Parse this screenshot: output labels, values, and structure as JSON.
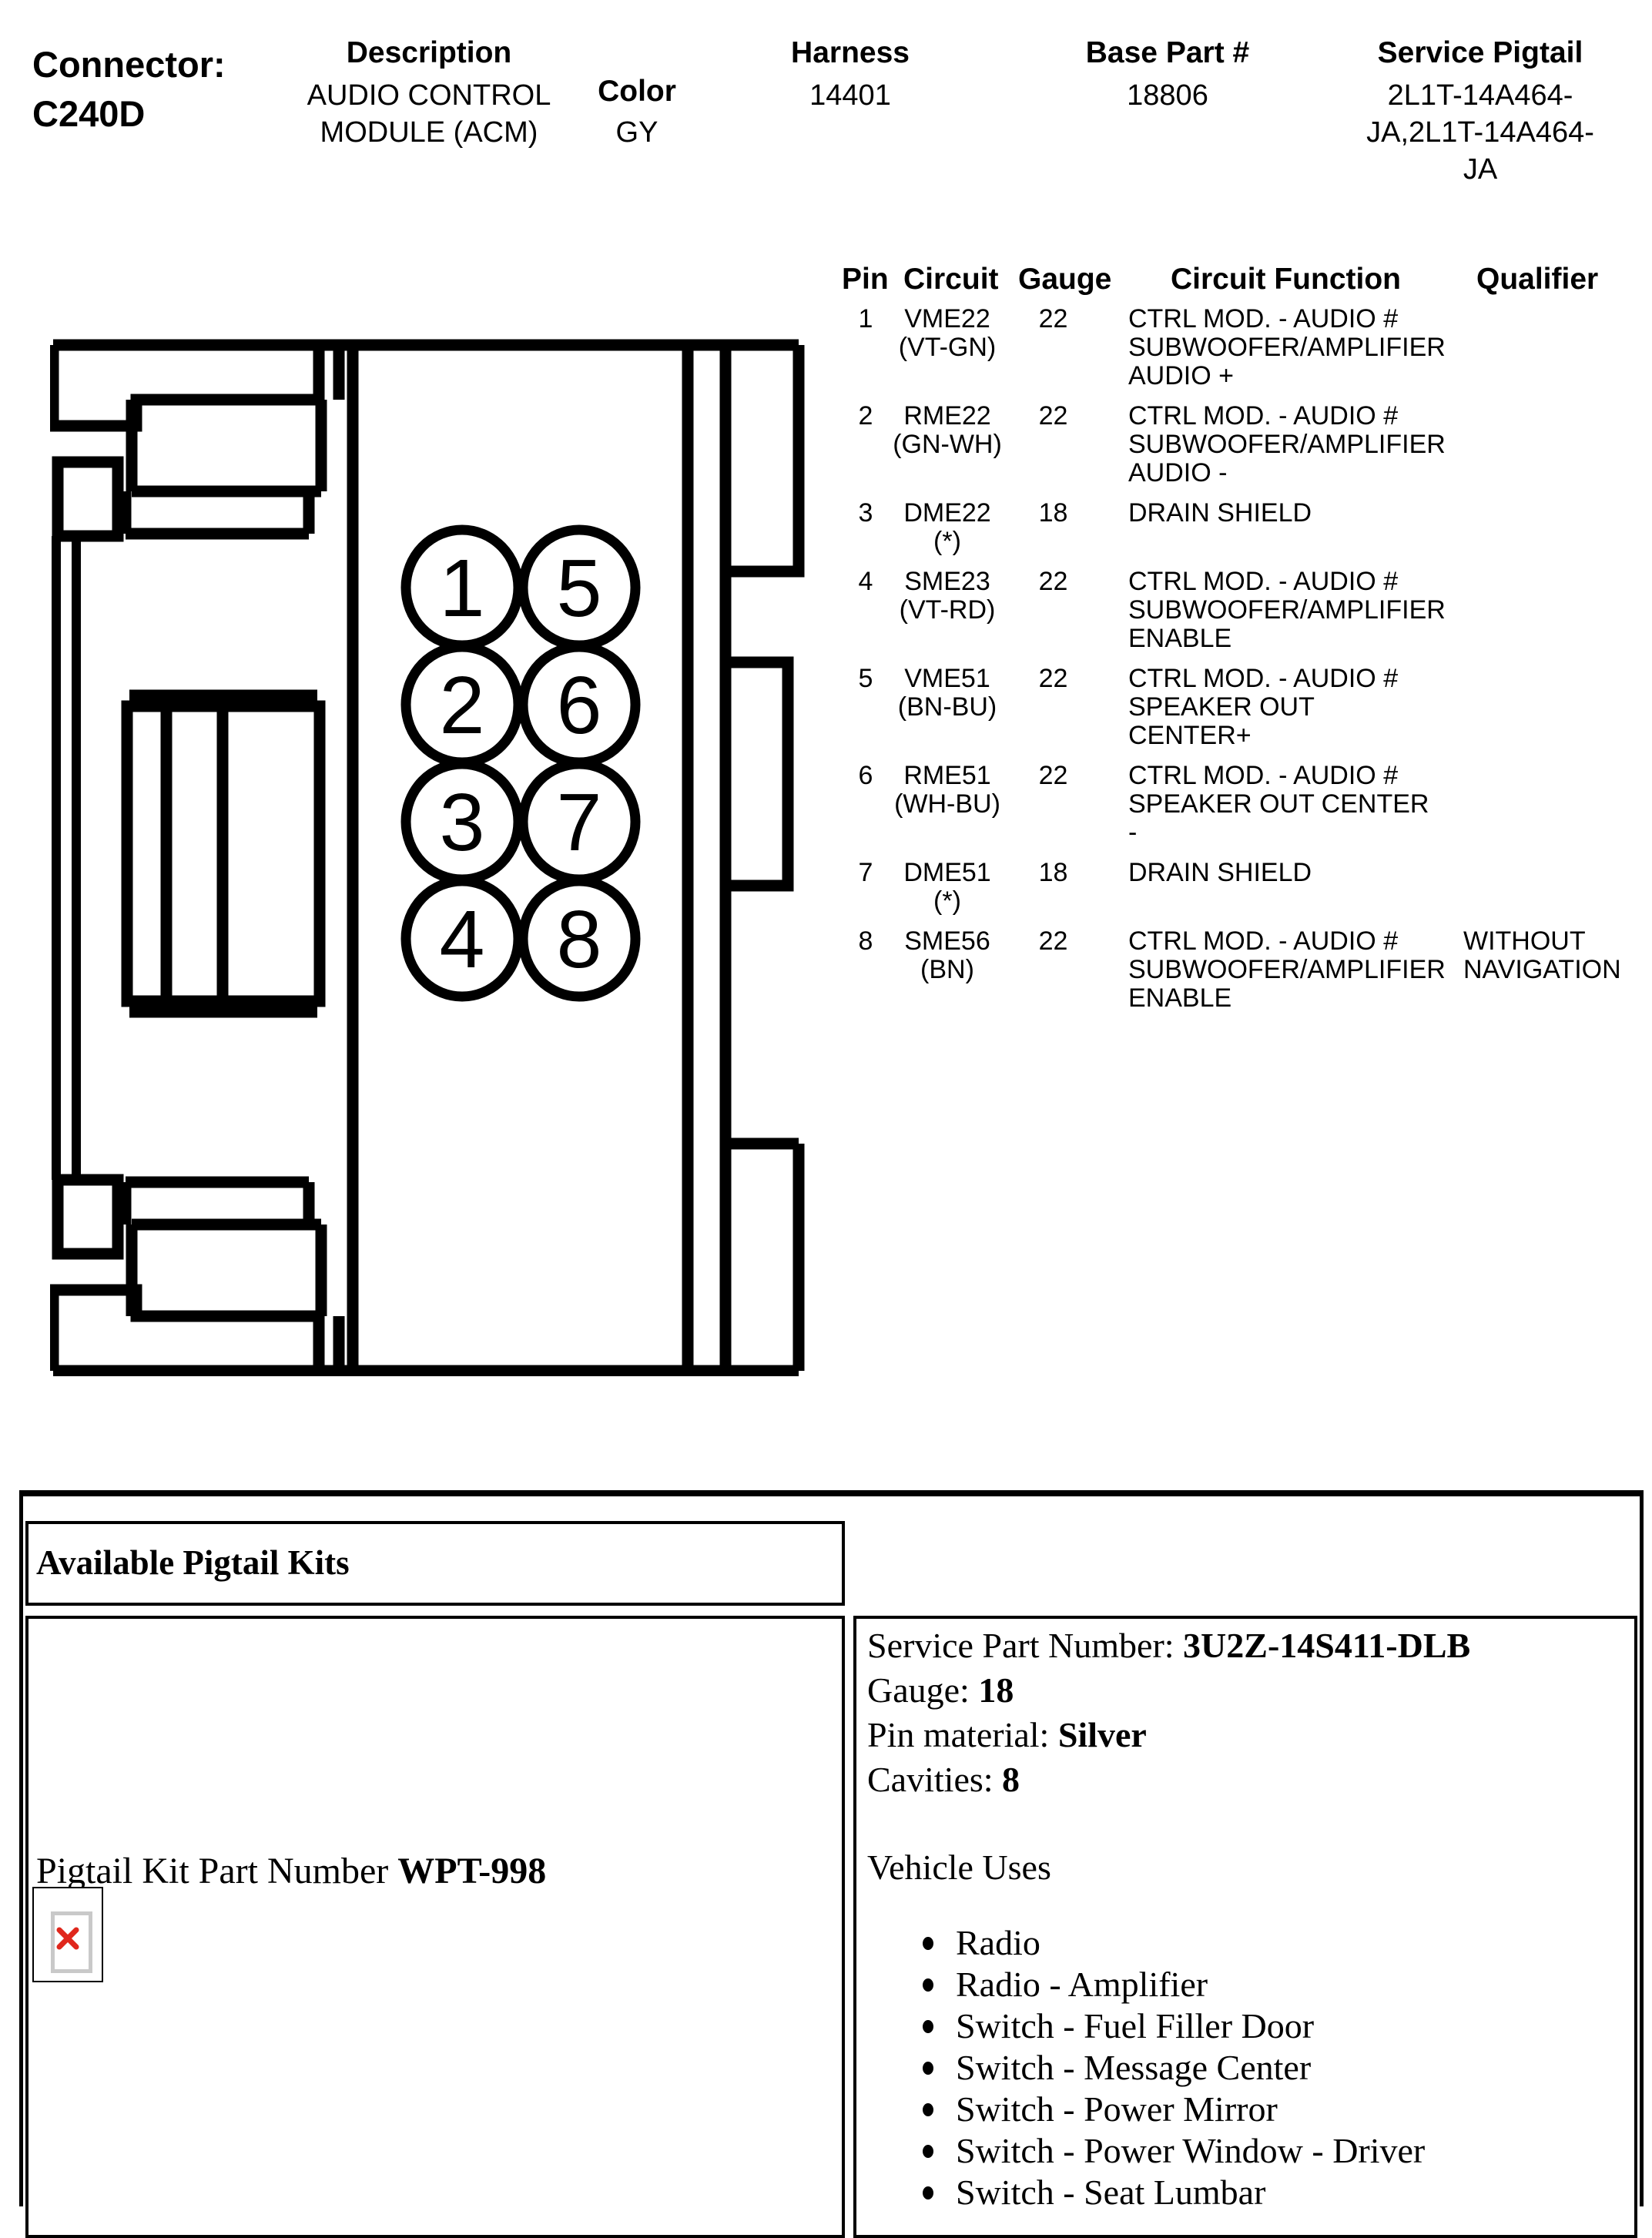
{
  "header": {
    "connector_label": "Connector:",
    "connector_id": "C240D",
    "fields": [
      {
        "label": "Description",
        "line1": "AUDIO CONTROL",
        "line2": "MODULE (ACM)",
        "line3": ""
      },
      {
        "label": "Color",
        "line1": "GY",
        "line2": "",
        "line3": ""
      },
      {
        "label": "Harness",
        "line1": "14401",
        "line2": "",
        "line3": ""
      },
      {
        "label": "Base Part #",
        "line1": "18806",
        "line2": "",
        "line3": ""
      },
      {
        "label": "Service Pigtail",
        "line1": "2L1T-14A464-",
        "line2": "JA,2L1T-14A464-",
        "line3": "JA"
      }
    ]
  },
  "pin_table": {
    "col_pin": "Pin",
    "col_circuit": "Circuit",
    "col_gauge": "Gauge",
    "col_function": "Circuit Function",
    "col_qualifier": "Qualifier",
    "rows": [
      {
        "pin": "1",
        "circuit": "VME22",
        "color": "(VT-GN)",
        "gauge": "22",
        "fn1": "CTRL MOD. - AUDIO #",
        "fn2": "SUBWOOFER/AMPLIFIER",
        "fn3": "AUDIO +",
        "q1": "",
        "q2": ""
      },
      {
        "pin": "2",
        "circuit": "RME22",
        "color": "(GN-WH)",
        "gauge": "22",
        "fn1": "CTRL MOD. - AUDIO #",
        "fn2": "SUBWOOFER/AMPLIFIER",
        "fn3": "AUDIO -",
        "q1": "",
        "q2": ""
      },
      {
        "pin": "3",
        "circuit": "DME22",
        "color": "(*)",
        "gauge": "18",
        "fn1": "DRAIN SHIELD",
        "fn2": "",
        "fn3": "",
        "q1": "",
        "q2": ""
      },
      {
        "pin": "4",
        "circuit": "SME23",
        "color": "(VT-RD)",
        "gauge": "22",
        "fn1": "CTRL MOD. - AUDIO #",
        "fn2": "SUBWOOFER/AMPLIFIER",
        "fn3": "ENABLE",
        "q1": "",
        "q2": ""
      },
      {
        "pin": "5",
        "circuit": "VME51",
        "color": "(BN-BU)",
        "gauge": "22",
        "fn1": "CTRL MOD. - AUDIO #",
        "fn2": "SPEAKER OUT CENTER+",
        "fn3": "",
        "q1": "",
        "q2": ""
      },
      {
        "pin": "6",
        "circuit": "RME51",
        "color": "(WH-BU)",
        "gauge": "22",
        "fn1": "CTRL MOD. - AUDIO #",
        "fn2": "SPEAKER OUT CENTER -",
        "fn3": "",
        "q1": "",
        "q2": ""
      },
      {
        "pin": "7",
        "circuit": "DME51",
        "color": "(*)",
        "gauge": "18",
        "fn1": "DRAIN SHIELD",
        "fn2": "",
        "fn3": "",
        "q1": "",
        "q2": ""
      },
      {
        "pin": "8",
        "circuit": "SME56",
        "color": "(BN)",
        "gauge": "22",
        "fn1": "CTRL MOD. - AUDIO #",
        "fn2": "SUBWOOFER/AMPLIFIER",
        "fn3": "ENABLE",
        "q1": "WITHOUT",
        "q2": "NAVIGATION"
      }
    ]
  },
  "diagram": {
    "pins": [
      "1",
      "2",
      "3",
      "4",
      "5",
      "6",
      "7",
      "8"
    ]
  },
  "pigtail": {
    "section_title": "Available Pigtail Kits",
    "kit_label": "Pigtail Kit Part Number ",
    "kit_number": "WPT-998",
    "details": [
      {
        "label": "Service Part Number: ",
        "value": "3U2Z-14S411-DLB"
      },
      {
        "label": "Gauge: ",
        "value": "18"
      },
      {
        "label": "Pin material: ",
        "value": "Silver"
      },
      {
        "label": "Cavities: ",
        "value": "8"
      }
    ],
    "vehicle_uses_title": "Vehicle Uses",
    "vehicle_uses": [
      "Radio",
      "Radio - Amplifier",
      "Switch - Fuel Filler Door",
      "Switch - Message Center",
      "Switch - Power Mirror",
      "Switch - Power Window - Driver",
      "Switch - Seat Lumbar"
    ]
  }
}
